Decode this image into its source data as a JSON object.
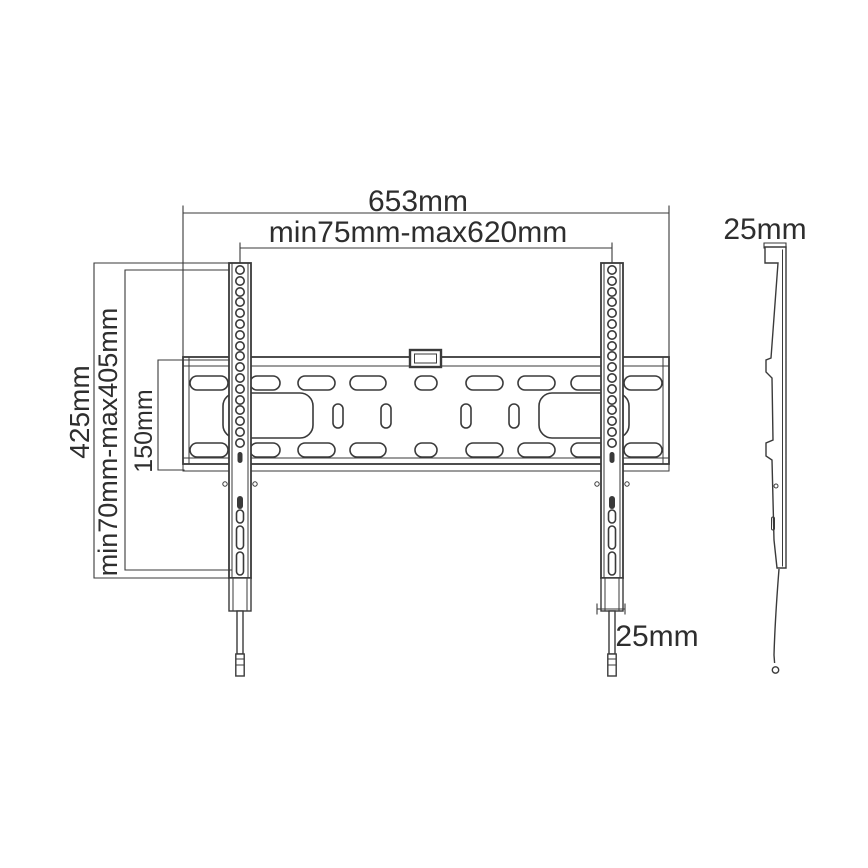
{
  "drawing": {
    "labels": {
      "overall_width": "653mm",
      "mount_width_range": "min75mm-max620mm",
      "overall_height": "425mm",
      "mount_height_range": "min70mm-max405mm",
      "plate_height": "150mm",
      "side_depth": "25mm",
      "bracket_width": "25mm"
    },
    "colors": {
      "ink": "#3a3a3a",
      "background": "#ffffff"
    }
  }
}
